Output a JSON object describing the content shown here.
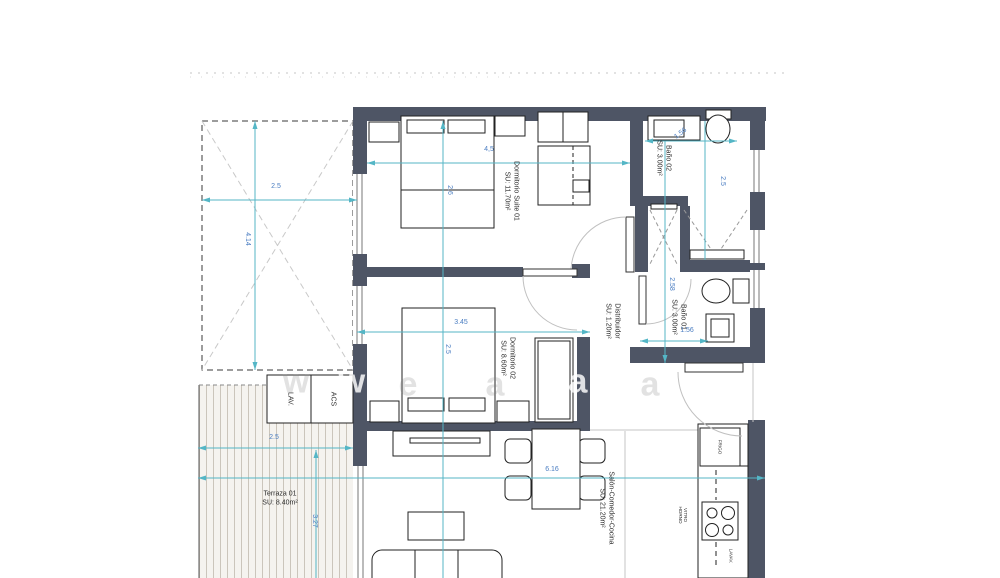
{
  "rooms": [
    {
      "name": "Dormitorio Suite 01",
      "area": "SU: 11.70m²"
    },
    {
      "name": "Baño 02",
      "area": "SU: 3.00m²"
    },
    {
      "name": "Baño 01",
      "area": "SU: 3.00m²"
    },
    {
      "name": "Distribuidor",
      "area": "SU: 1.20m²"
    },
    {
      "name": "Dormitorio 02",
      "area": "SU: 8.60m²"
    },
    {
      "name": "Terraza 01",
      "area": "SU: 8.40m²"
    },
    {
      "name": "Salón-Comedor-Cocina",
      "area": "SU: 21.20m²"
    }
  ],
  "closets": {
    "lav": "LAV.",
    "acs": "ACS"
  },
  "kitchen": {
    "fridge": "FRIGO",
    "hob_line1": "VITRO",
    "hob_line2": "HORNO",
    "dishwasher": "LAVAV."
  },
  "dimensions": {
    "patio_w": "2.5",
    "patio_h": "4.14",
    "suite_w": "4,5",
    "suite_h": "2.6",
    "bano02_w": "1.56",
    "bano02_h": "2.5",
    "hall_h": "2.58",
    "bano01_w": "1.56",
    "dorm02_w": "3.45",
    "dorm02_h": "2.5",
    "terraza_w": "2.5",
    "terraza_h": "3.27",
    "salon_w": "6.16"
  },
  "watermark": {
    "letters": [
      "w",
      "w",
      "e",
      "a",
      "a",
      "a"
    ]
  },
  "colors": {
    "wall": "#4e5565",
    "dim_line": "#54b6c6",
    "dim_text": "#4b7ec2",
    "hatch": "#cbc5bb"
  }
}
